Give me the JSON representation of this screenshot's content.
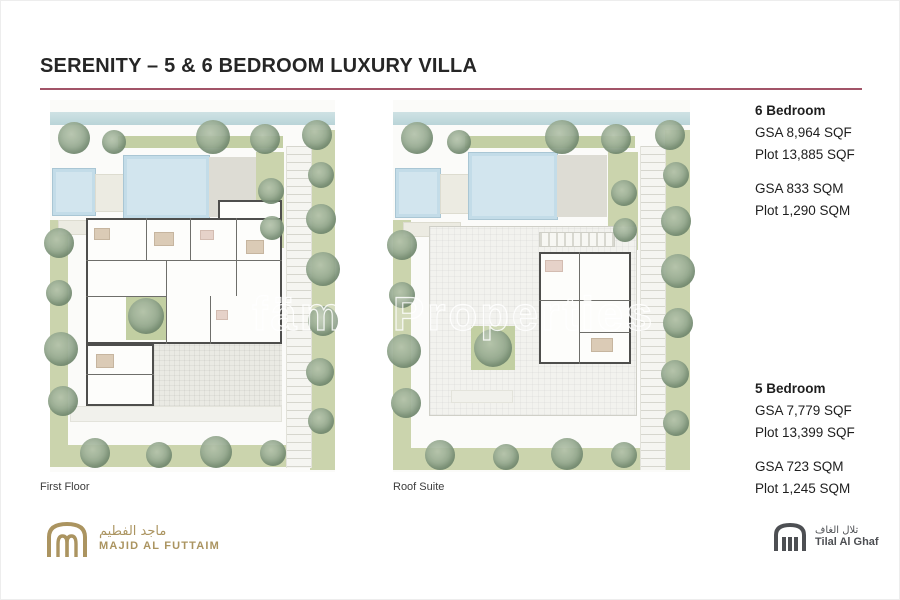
{
  "page": {
    "title": "SERENITY – 5 & 6 BEDROOM LUXURY VILLA"
  },
  "watermark": {
    "text": "fäm | Properties"
  },
  "plans": [
    {
      "caption": "First Floor"
    },
    {
      "caption": "Roof Suite"
    }
  ],
  "specs": [
    {
      "heading": "6 Bedroom",
      "sqf": [
        "GSA 8,964 SQF",
        "Plot 13,885 SQF"
      ],
      "sqm": [
        "GSA 833 SQM",
        "Plot 1,290 SQM"
      ]
    },
    {
      "heading": "5 Bedroom",
      "sqf": [
        "GSA 7,779 SQF",
        "Plot 13,399 SQF"
      ],
      "sqm": [
        "GSA 723 SQM",
        "Plot 1,245 SQM"
      ]
    }
  ],
  "footer": {
    "majid_al_futtaim": {
      "arabic": "ماجد الفطيم",
      "name": "MAJID AL FUTTAIM"
    },
    "tilal_al_ghaf": {
      "arabic": "تلال الغاف",
      "name": "Tilal Al Ghaf"
    }
  },
  "colors": {
    "accent_line": "#a25468",
    "maf_gold": "#ab9460",
    "tag_gray": "#4d4f53",
    "pool_blue": "#cfe3ec",
    "landscape_green": "#cbd4ad"
  }
}
